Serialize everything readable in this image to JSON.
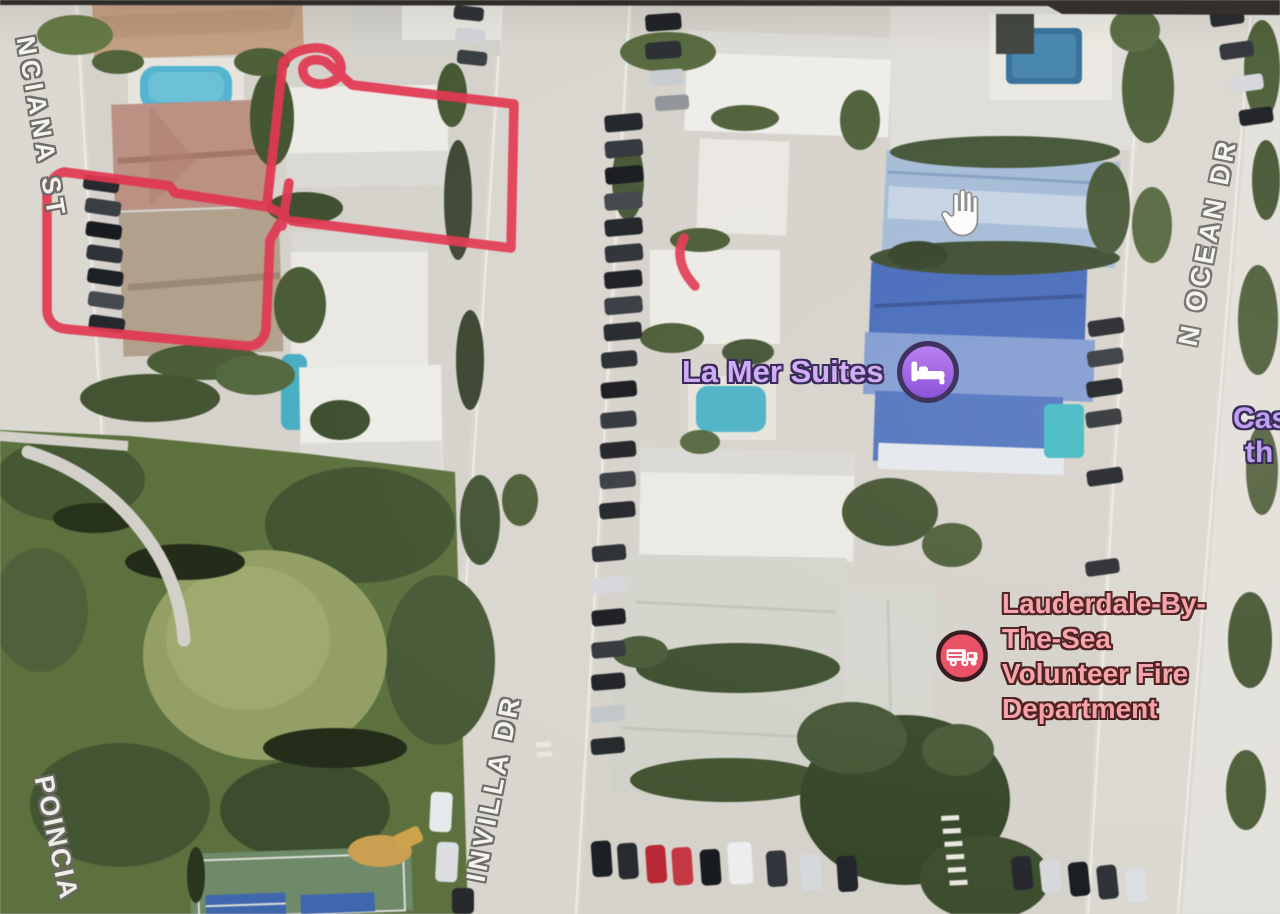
{
  "streets": {
    "top_left": "NCIANA ST",
    "bottom_left": "POINCIA",
    "center": "INVILLA DR",
    "right": "N OCEAN DR"
  },
  "pois": {
    "hotel": {
      "label": "La Mer Suites",
      "icon": "bed-icon"
    },
    "fire_station": {
      "lines": [
        "Lauderdale-By-",
        "The-Sea",
        "Volunteer Fire",
        "Department"
      ],
      "icon": "fire-truck-icon"
    },
    "partial_right": {
      "lines": [
        "Cas",
        "th"
      ]
    }
  },
  "cursor": {
    "icon": "open-hand-icon"
  },
  "colors": {
    "annotation_red": "#ee3350",
    "street_label_text": "#f5f4ef",
    "street_label_outline": "#6a6963",
    "hotel_label_text": "#cfa7f7",
    "hotel_icon_fill": "#8f4fe0",
    "hotel_icon_ring": "#2e2253",
    "fire_label_text": "#f79fa8",
    "fire_icon_fill": "#e84a60",
    "fire_icon_ring": "#2d1117",
    "bezel_bar": "#2e2a27"
  }
}
